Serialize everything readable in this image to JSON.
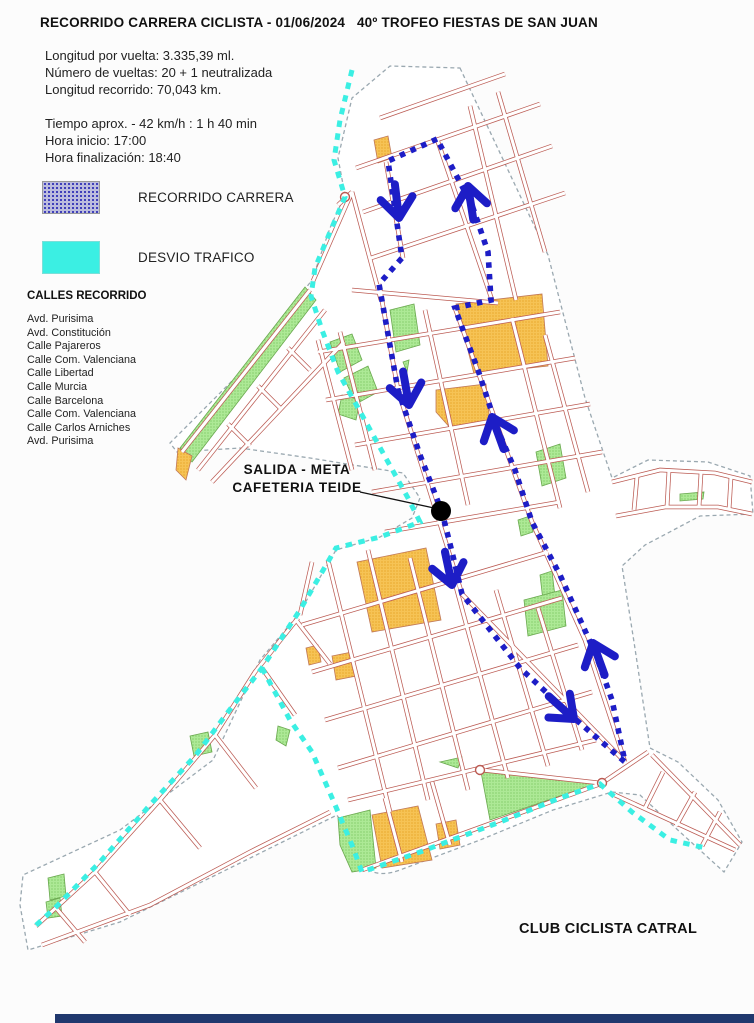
{
  "header": {
    "title": "RECORRIDO CARRERA CICLISTA - 01/06/2024   40º TROFEO FIESTAS DE SAN JUAN",
    "info_block_1": [
      "Longitud por vuelta: 3.335,39 ml.",
      "Número de vueltas: 20 + 1 neutralizada",
      "Longitud recorrido: 70,043 km."
    ],
    "info_block_2": [
      "Tiempo aprox. - 42 km/h : 1 h 40 min",
      "Hora inicio: 17:00",
      "Hora finalización: 18:40"
    ]
  },
  "legend": {
    "items": [
      {
        "label": "RECORRIDO CARRERA",
        "swatch": "dotted-purple",
        "color": "#2a2ab4"
      },
      {
        "label": "DESVIO TRAFICO",
        "swatch": "solid-cyan",
        "color": "#3BEFE3"
      }
    ]
  },
  "streets_list": {
    "heading": "CALLES RECORRIDO",
    "items": [
      "Avd. Purisima",
      "Avd. Constitución",
      "Calle Pajareros",
      "Calle Com. Valenciana",
      "Calle Libertad",
      "Calle Murcia",
      "Calle Barcelona",
      "Calle Com. Valenciana",
      "Calle Carlos Arniches",
      "Avd. Purisima"
    ]
  },
  "map": {
    "start_finish": {
      "line1": "SALIDA - META",
      "line2": "CAFETERIA TEIDE"
    },
    "club": "CLUB CICLISTA CATRAL",
    "colors": {
      "route": "#1d1dc6",
      "diversion": "#3BEFE3",
      "street": "#bb5a52",
      "boundary": "#9aa8b0",
      "park": "#a5e78e",
      "building": "#f5bb45",
      "marker": "#000000"
    }
  }
}
